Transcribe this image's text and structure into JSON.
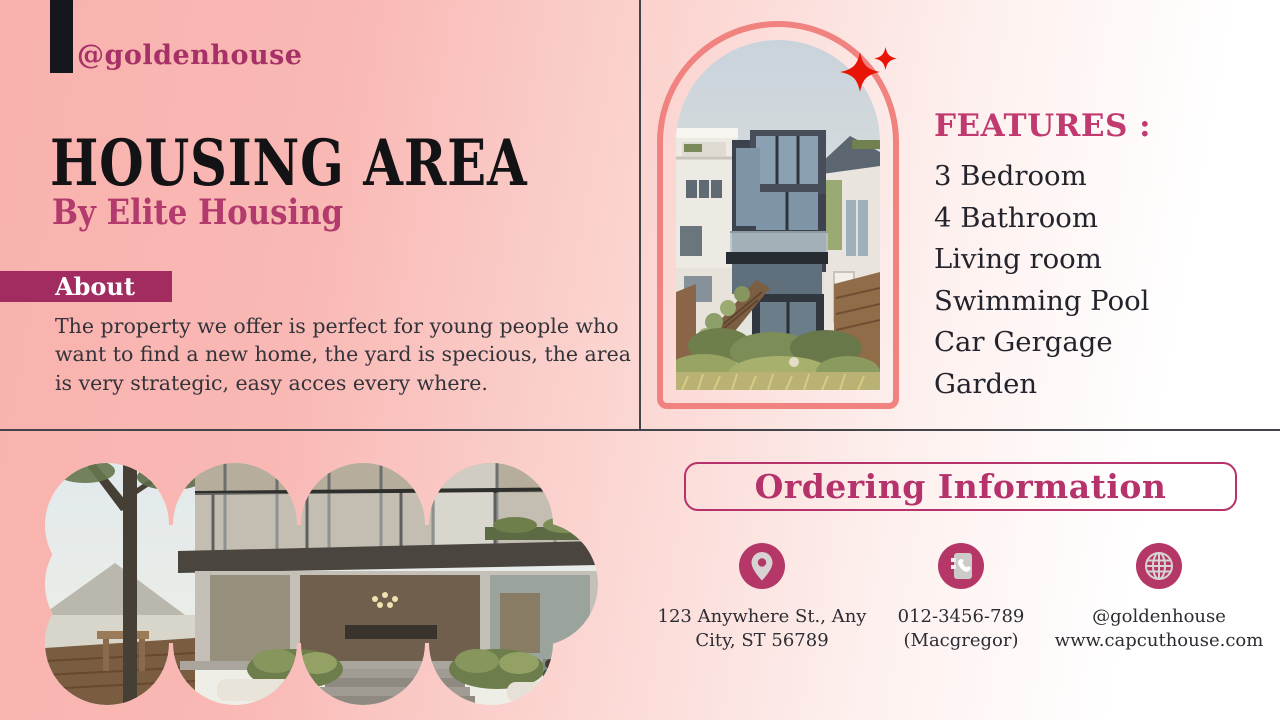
{
  "brand": {
    "handle": "@goldenhouse"
  },
  "hero": {
    "title": "HOUSING AREA",
    "subtitle": "By Elite Housing"
  },
  "about": {
    "label": "About",
    "body": "The property we offer is perfect for young people who want to find a new home, the yard is specious, the area is very strategic, easy acces every where."
  },
  "features": {
    "heading": "FEATURES :",
    "items": [
      "3 Bedroom",
      "4 Bathroom",
      "Living room",
      "Swimming Pool",
      "Car Gergage",
      "Garden"
    ]
  },
  "ordering": {
    "heading": "Ordering Information",
    "contacts": [
      {
        "icon": "location-pin-icon",
        "line1": "123 Anywhere St., Any",
        "line2": "City, ST 56789"
      },
      {
        "icon": "phone-book-icon",
        "line1": "012-3456-789",
        "line2": "(Macgregor)"
      },
      {
        "icon": "globe-icon",
        "line1": "@goldenhouse",
        "line2": "www.capcuthouse.com"
      }
    ]
  },
  "decor": {
    "sparkles": "sparkle-icon",
    "arch_photo": "arch-house-photo",
    "blob_photo": "scalloped-house-photo"
  },
  "colors": {
    "background_pink": "#f9b2ae",
    "accent_dark": "#a22c60",
    "accent": "#b5326b",
    "heading_pink": "#c03a70",
    "arch_border": "#f0827f",
    "sparkle_red": "#e81507",
    "divider": "#43434a",
    "title_black": "#131316",
    "icon_circle": "#b43768"
  }
}
